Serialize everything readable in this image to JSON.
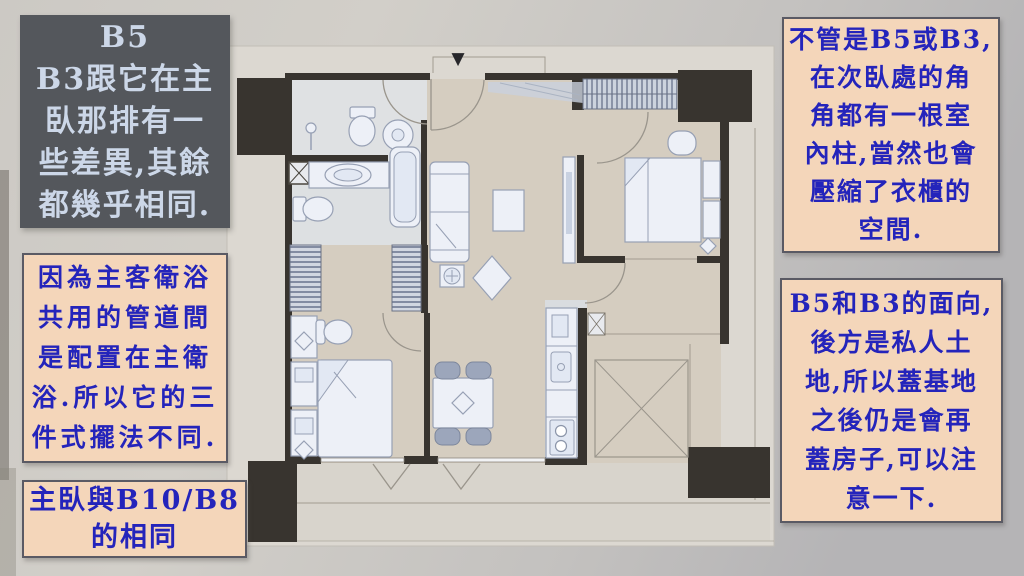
{
  "colors": {
    "photo_bg": "#c9c6c1",
    "plan_sheet": "#dcd8d1",
    "plan_floor": "#d5cdc0",
    "wall": "#38342f",
    "note_bg": "#f4d6ba",
    "note_border": "#5a5a64",
    "note_text": "#2424bb",
    "dark_note_bg": "#54575c",
    "dark_note_text": "#ccd7e8"
  },
  "floor_plan": {
    "entrance_marker": "▼"
  },
  "notes": {
    "top_left": "B5\nB3跟它在主\n臥那排有一\n些差異,其餘\n都幾乎相同.",
    "mid_left": "因為主客衛浴\n共用的管道間\n是配置在主衛\n浴.所以它的三\n件式擺法不同.",
    "bottom_left": "主臥與B10/B8\n的相同",
    "top_right": "不管是B5或B3,\n在次臥處的角\n角都有一根室\n內柱,當然也會\n壓縮了衣櫃的\n空間.",
    "bottom_right": "B5和B3的面向,\n後方是私人土\n地,所以蓋基地\n之後仍是會再\n蓋房子,可以注\n意一下."
  }
}
